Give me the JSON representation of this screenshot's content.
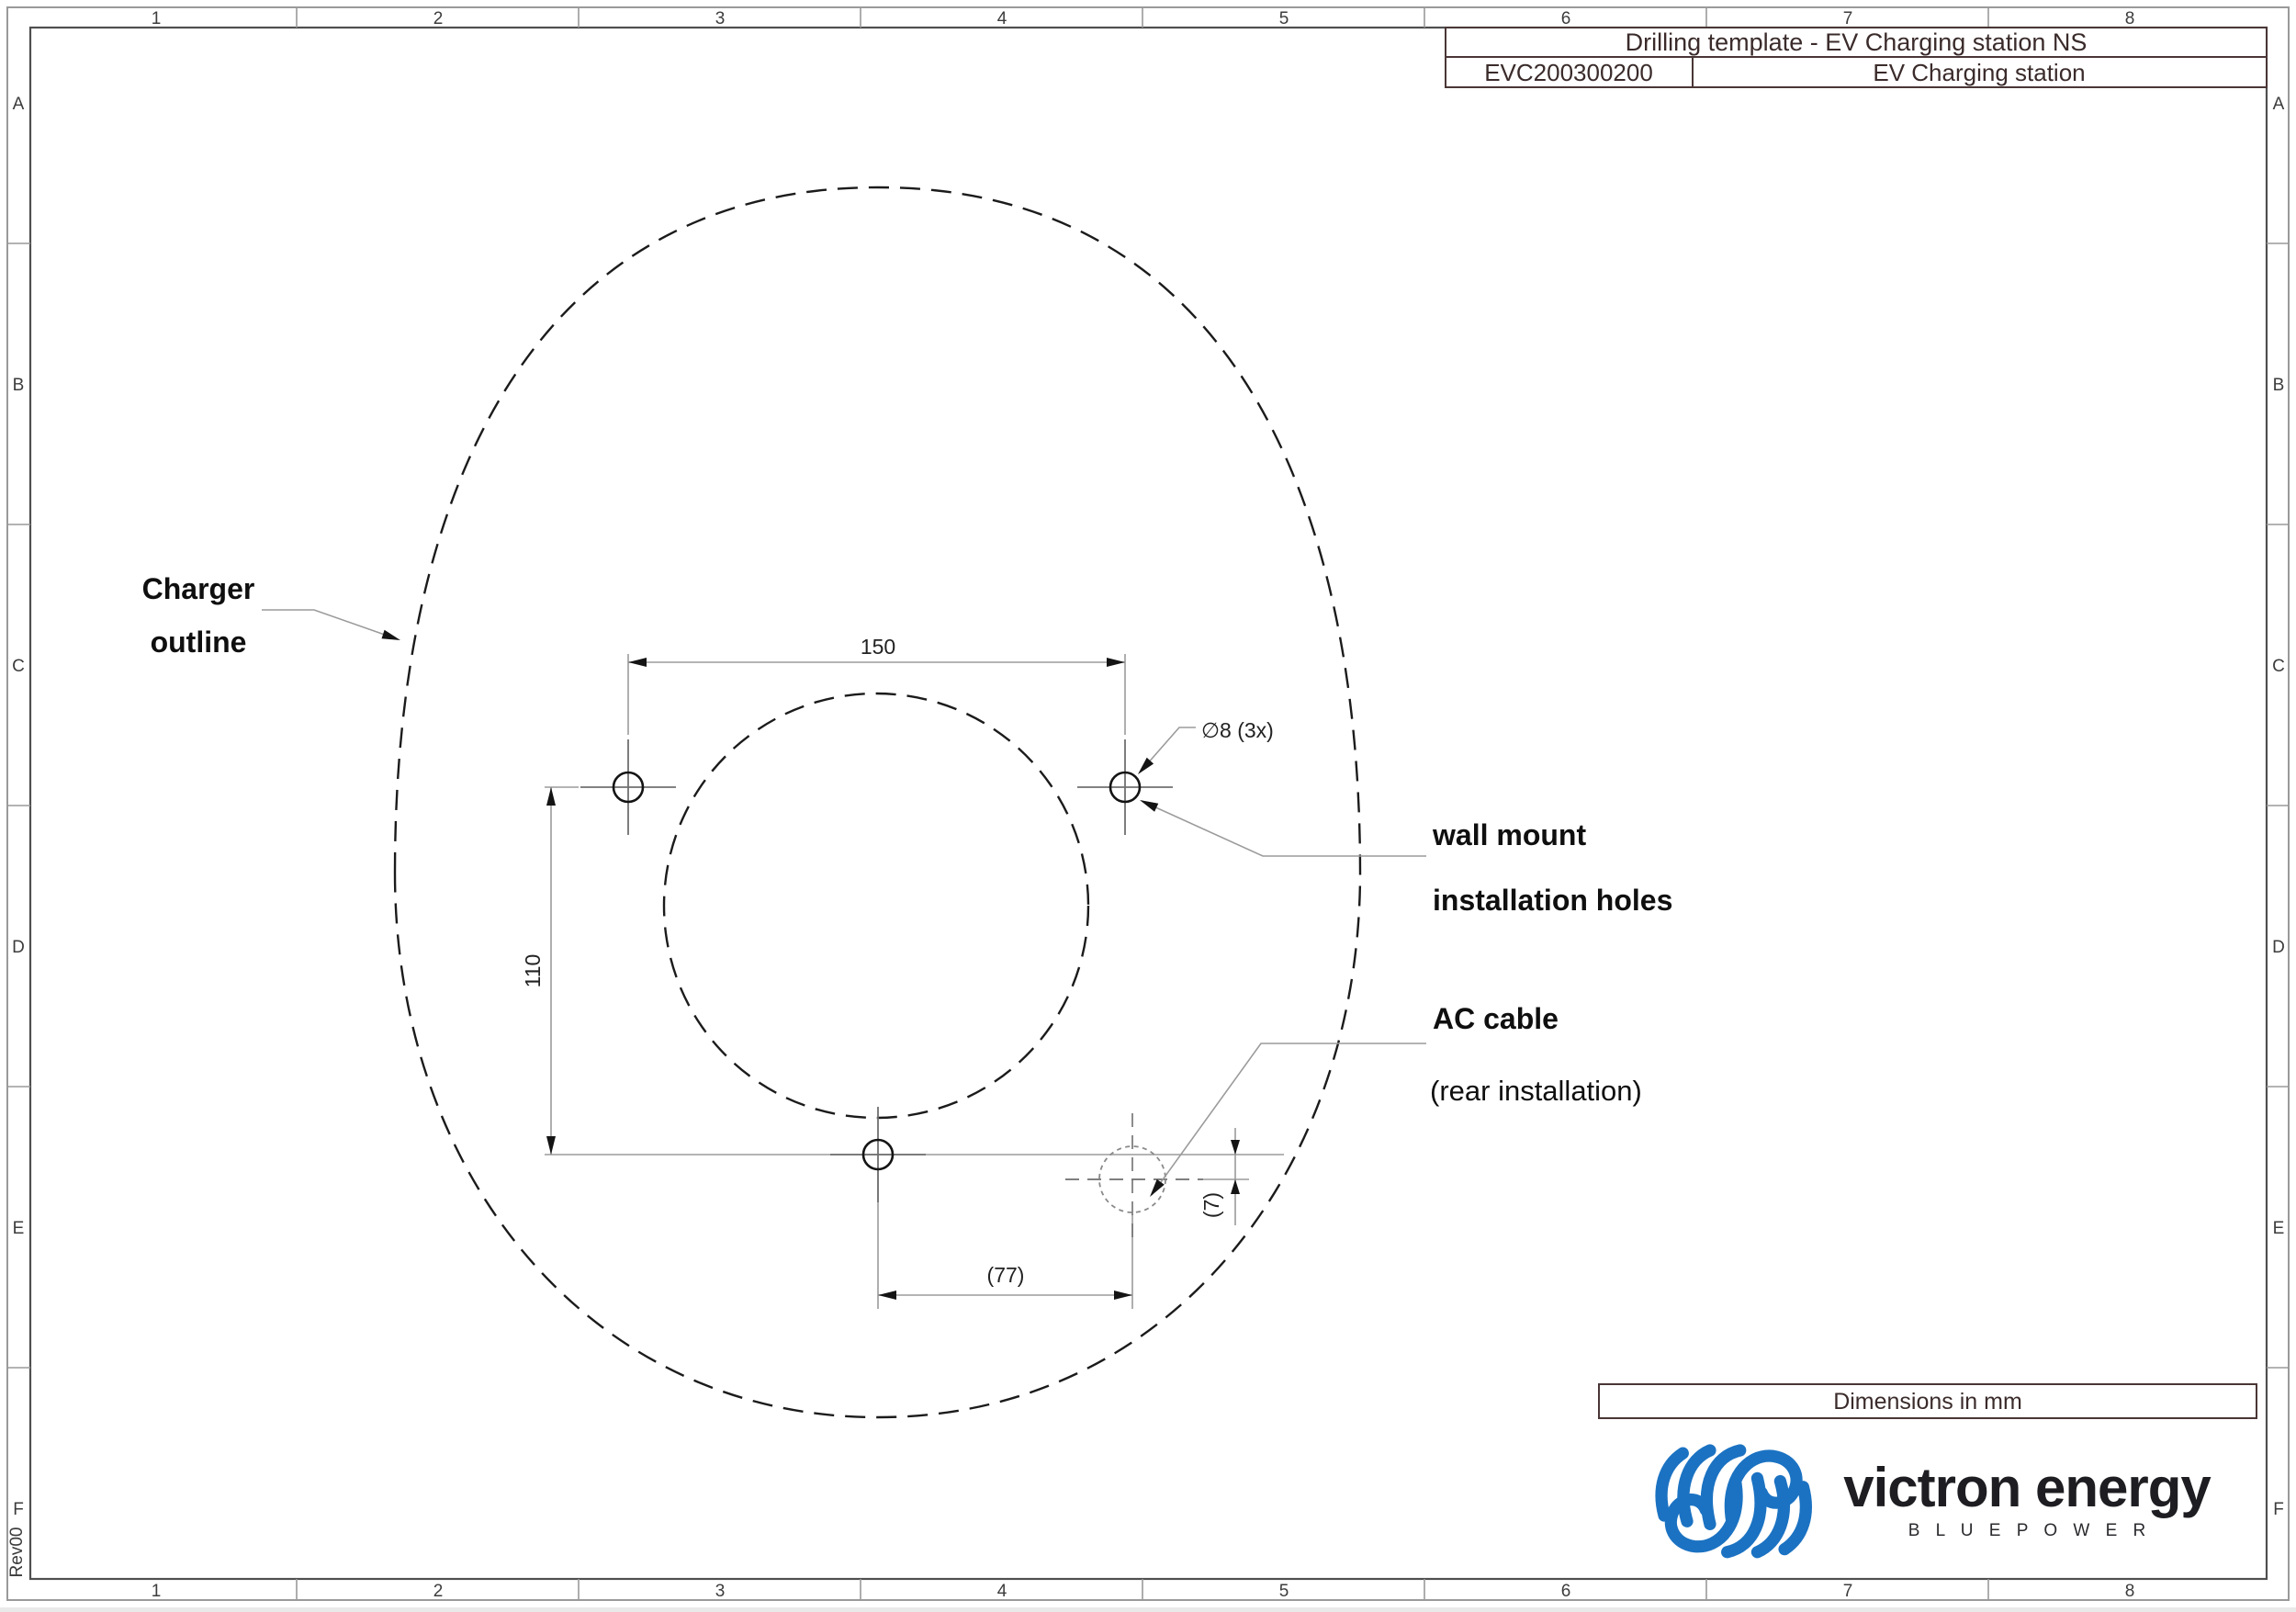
{
  "title_block": {
    "title": "Drilling template - EV Charging station NS",
    "part_number": "EVC200300200",
    "product": "EV Charging station"
  },
  "grid": {
    "cols": [
      "1",
      "2",
      "3",
      "4",
      "5",
      "6",
      "7",
      "8"
    ],
    "rows": [
      "A",
      "B",
      "C",
      "D",
      "E",
      "F"
    ]
  },
  "annotations": {
    "charger_outline_line1": "Charger",
    "charger_outline_line2": "outline",
    "wall_mount_line1": "wall mount",
    "wall_mount_line2": "installation holes",
    "ac_cable_line1": "AC cable",
    "ac_cable_line2": "(rear installation)"
  },
  "dimensions": {
    "hole_spacing_horizontal": "150",
    "hole_spacing_vertical": "110",
    "ac_cable_offset_horizontal": "(77)",
    "ac_cable_offset_vertical": "(7)",
    "hole_diameter": "∅8 (3x)"
  },
  "footer": {
    "units_note": "Dimensions in mm",
    "revision": "Rev00"
  },
  "brand": {
    "name": "victron energy",
    "tagline": "B L U E   P O W E R",
    "blue": "#1b72c2"
  }
}
